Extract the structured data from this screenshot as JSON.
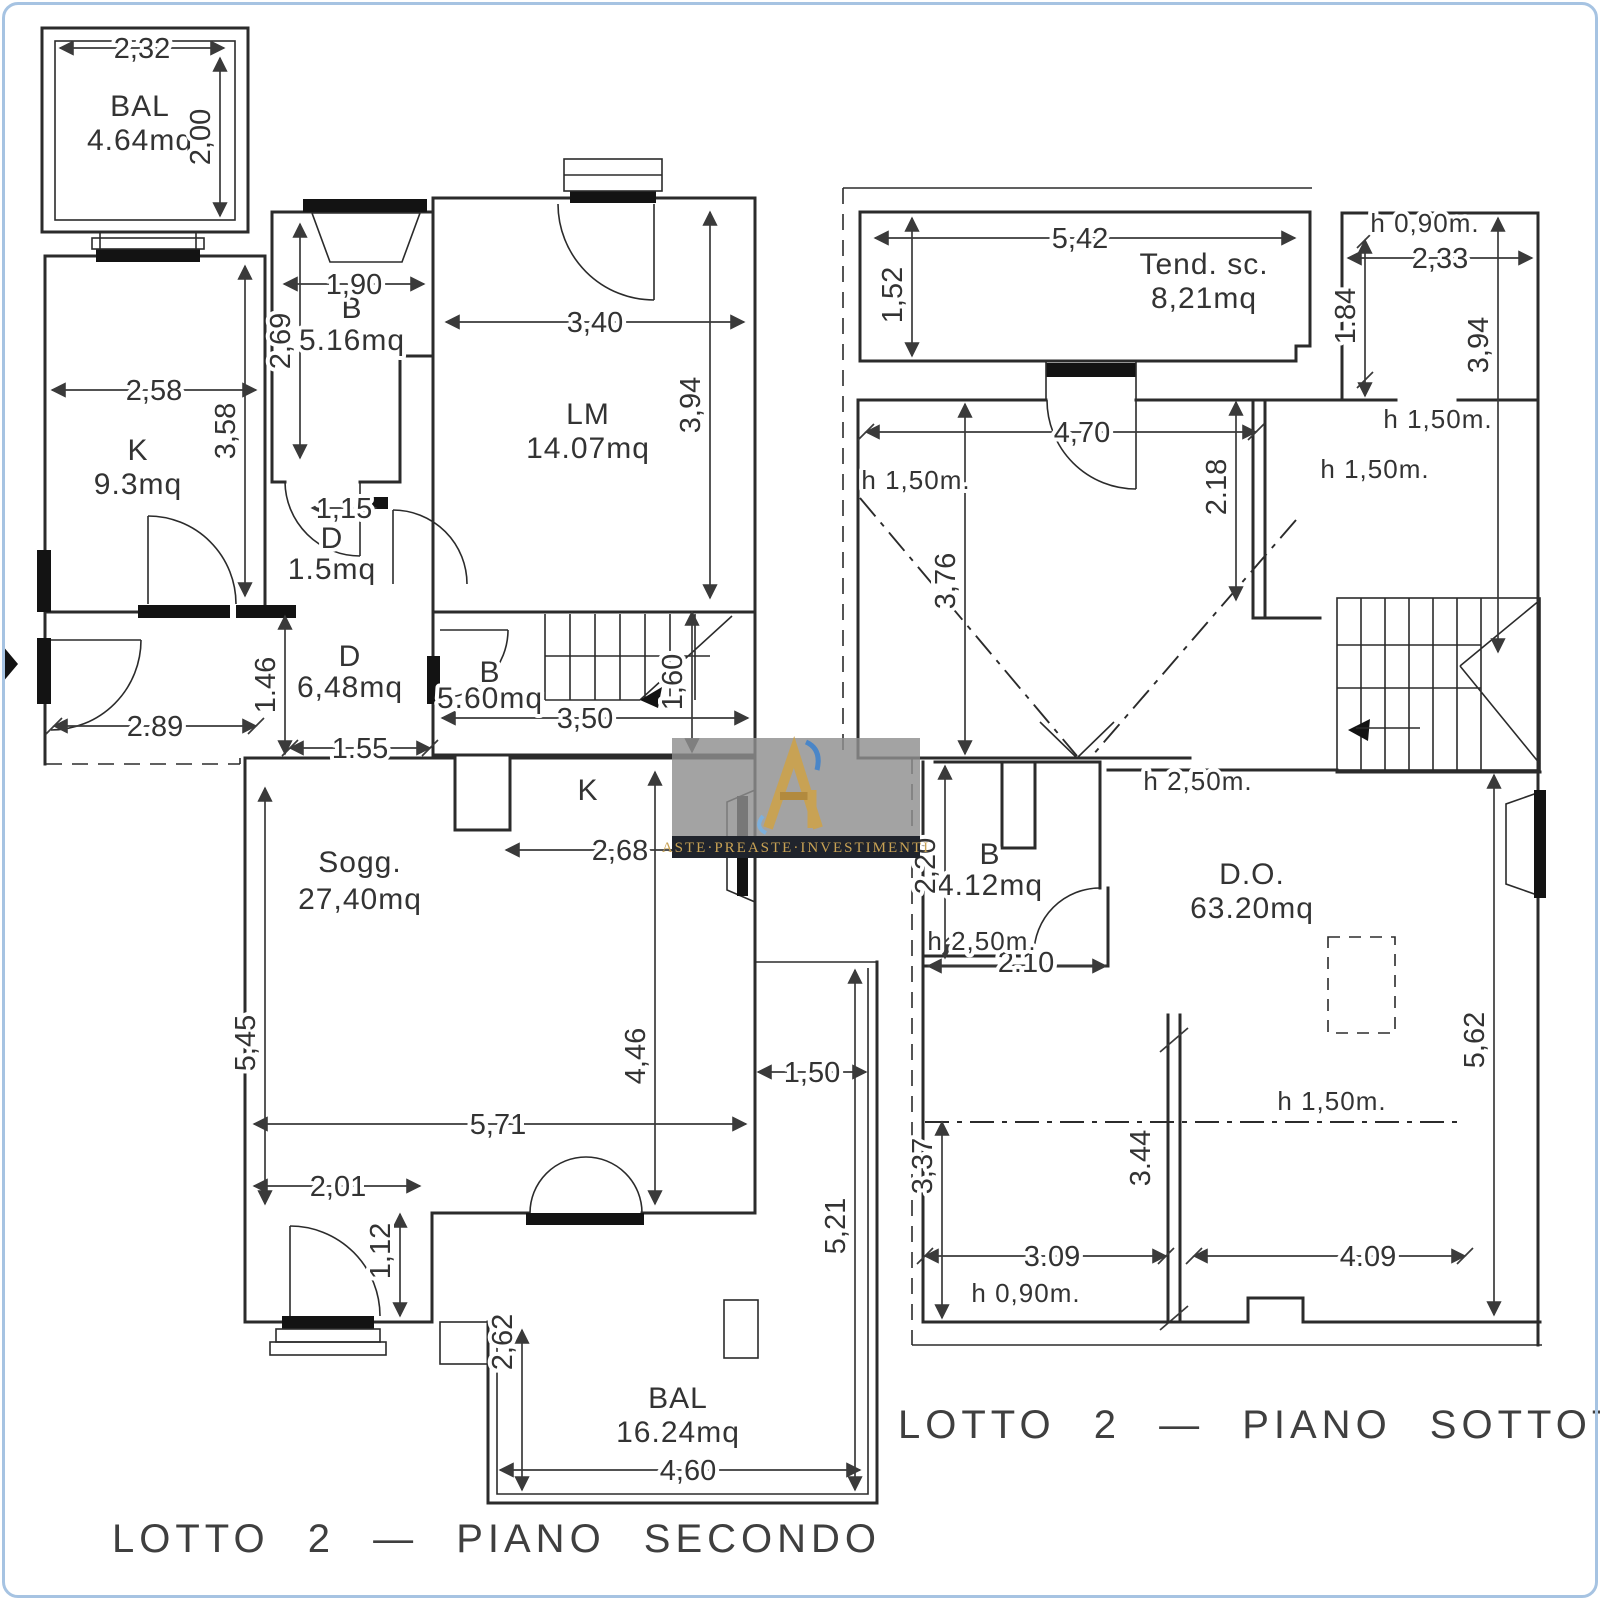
{
  "page": {
    "background": "#ffffff",
    "border_color": "#a6c3e2"
  },
  "watermark": {
    "text": "ASTE·PREASTE·INVESTIMENTI",
    "logo": "ri-monogram-logo",
    "gold": "#c8a254",
    "blue": "#4a86c8",
    "band_bg": "#20242c",
    "box_bg": "#8f8f8f"
  },
  "captions": {
    "left": "LOTTO 2 — PIANO SECONDO",
    "right": "LOTTO 2 — PIANO SOTTOTETTO"
  },
  "plans": [
    {
      "id": "secondo",
      "rooms": [
        {
          "label": "BAL",
          "area": "4.64mq",
          "x": 140,
          "y": 116
        },
        {
          "label": "B",
          "area": "5.16mq",
          "x": 352,
          "y": 318,
          "size": 28
        },
        {
          "label": "LM",
          "area": "14.07mq",
          "x": 588,
          "y": 424
        },
        {
          "label": "K",
          "area": "9.3mq",
          "x": 138,
          "y": 460
        },
        {
          "label": "D",
          "area": "1.5mq",
          "x": 332,
          "y": 548,
          "size": 27
        },
        {
          "label": "D",
          "area": "6,48mq",
          "x": 350,
          "y": 666,
          "size": 27
        },
        {
          "label": "B",
          "area": "5.60mq",
          "x": 490,
          "y": 682,
          "size": 22
        },
        {
          "label": "K",
          "area": "",
          "x": 588,
          "y": 800,
          "size": 38
        },
        {
          "label": "Sogg.",
          "area": "27,40mq",
          "x": 360,
          "y": 872,
          "size": 33
        },
        {
          "label": "BAL",
          "area": "16.24mq",
          "x": 678,
          "y": 1408
        }
      ],
      "dims": [
        {
          "t": "2,32",
          "x": 142,
          "y": 58
        },
        {
          "t": "2,00",
          "x": 210,
          "y": 137,
          "v": 1
        },
        {
          "t": "1,90",
          "x": 354,
          "y": 294
        },
        {
          "t": "2,69",
          "x": 290,
          "y": 341,
          "v": 1
        },
        {
          "t": "3,40",
          "x": 595,
          "y": 332
        },
        {
          "t": "3,94",
          "x": 700,
          "y": 405,
          "v": 1
        },
        {
          "t": "2,58",
          "x": 154,
          "y": 400
        },
        {
          "t": "3,58",
          "x": 235,
          "y": 431,
          "v": 1
        },
        {
          "t": "1,15",
          "x": 344,
          "y": 518,
          "size": 26
        },
        {
          "t": "1.46",
          "x": 275,
          "y": 685,
          "v": 1,
          "size": 26
        },
        {
          "t": "2.89",
          "x": 155,
          "y": 736
        },
        {
          "t": "1.55",
          "x": 360,
          "y": 758,
          "size": 26
        },
        {
          "t": "3,50",
          "x": 585,
          "y": 728
        },
        {
          "t": "1,60",
          "x": 682,
          "y": 682,
          "v": 1
        },
        {
          "t": "2,68",
          "x": 620,
          "y": 860
        },
        {
          "t": "5,45",
          "x": 255,
          "y": 1043,
          "v": 1
        },
        {
          "t": "4,46",
          "x": 645,
          "y": 1056,
          "v": 1
        },
        {
          "t": "5,71",
          "x": 498,
          "y": 1134
        },
        {
          "t": "2,01",
          "x": 338,
          "y": 1196
        },
        {
          "t": "1,12",
          "x": 390,
          "y": 1251,
          "v": 1,
          "size": 26
        },
        {
          "t": "1,50",
          "x": 812,
          "y": 1082,
          "size": 26
        },
        {
          "t": "5,21",
          "x": 845,
          "y": 1226,
          "v": 1,
          "size": 26
        },
        {
          "t": "2,62",
          "x": 512,
          "y": 1342,
          "v": 1,
          "size": 26
        },
        {
          "t": "4,60",
          "x": 688,
          "y": 1480
        }
      ],
      "notes": []
    },
    {
      "id": "sottotetto",
      "rooms": [
        {
          "label": "Tend. sc.",
          "area": "8,21mq",
          "x": 1204,
          "y": 274
        },
        {
          "label": "B",
          "area": "4.12mq",
          "x": 990,
          "y": 864,
          "size": 27
        },
        {
          "label": "D.O.",
          "area": "63.20mq",
          "x": 1252,
          "y": 884
        }
      ],
      "dims": [
        {
          "t": "5,42",
          "x": 1080,
          "y": 248
        },
        {
          "t": "1,52",
          "x": 902,
          "y": 295,
          "v": 1,
          "size": 26
        },
        {
          "t": "2,33",
          "x": 1440,
          "y": 268,
          "size": 26
        },
        {
          "t": "1.84",
          "x": 1355,
          "y": 316,
          "v": 1,
          "size": 24
        },
        {
          "t": "3,94",
          "x": 1488,
          "y": 345,
          "v": 1,
          "size": 26
        },
        {
          "t": "4,70",
          "x": 1082,
          "y": 442,
          "size": 26
        },
        {
          "t": "2.18",
          "x": 1226,
          "y": 487,
          "v": 1,
          "size": 24
        },
        {
          "t": "3,76",
          "x": 955,
          "y": 581,
          "v": 1,
          "size": 26
        },
        {
          "t": "2,20",
          "x": 935,
          "y": 866,
          "v": 1,
          "size": 24
        },
        {
          "t": "2.10",
          "x": 1026,
          "y": 972,
          "size": 24
        },
        {
          "t": "3,37",
          "x": 932,
          "y": 1166,
          "v": 1,
          "size": 24
        },
        {
          "t": "3.44",
          "x": 1150,
          "y": 1158,
          "v": 1,
          "size": 24
        },
        {
          "t": "5,62",
          "x": 1484,
          "y": 1040,
          "v": 1,
          "size": 26
        },
        {
          "t": "3.09",
          "x": 1052,
          "y": 1266,
          "size": 24
        },
        {
          "t": "4.09",
          "x": 1368,
          "y": 1266,
          "size": 24
        }
      ],
      "notes": [
        {
          "t": "h 0,90m.",
          "x": 1425,
          "y": 232
        },
        {
          "t": "h 1,50m.",
          "x": 1438,
          "y": 428
        },
        {
          "t": "h 1,50m.",
          "x": 1375,
          "y": 478
        },
        {
          "t": "h 1,50m.",
          "x": 916,
          "y": 489
        },
        {
          "t": "h 2,50m.",
          "x": 1198,
          "y": 790
        },
        {
          "t": "h 2,50m.",
          "x": 982,
          "y": 950
        },
        {
          "t": "h 1,50m.",
          "x": 1332,
          "y": 1110
        },
        {
          "t": "h 0,90m.",
          "x": 1026,
          "y": 1302
        }
      ]
    }
  ]
}
